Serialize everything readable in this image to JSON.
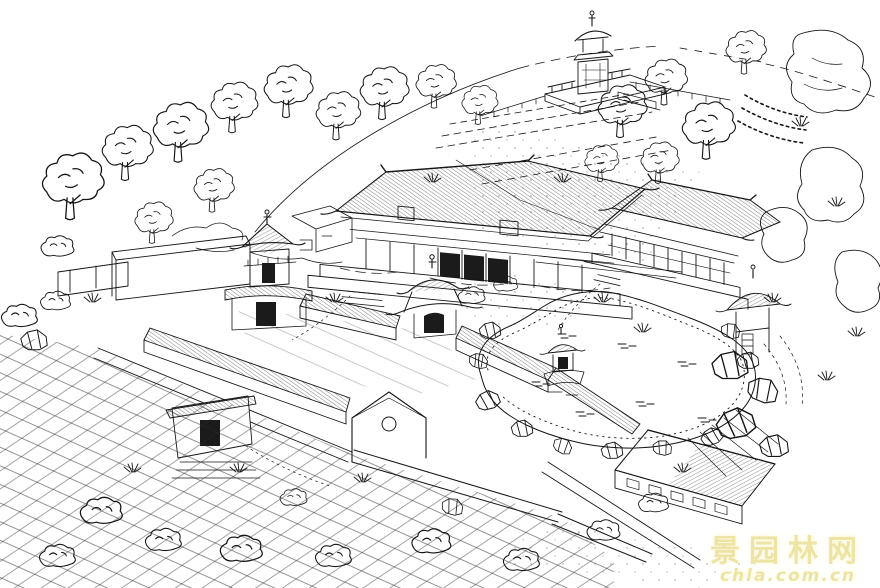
{
  "watermark": {
    "line1": "景园林网",
    "line2": "chla.com.cn",
    "text_color": "#e8dd94",
    "glow_color": "#fdf7d2"
  },
  "palette": {
    "ink": "#161616",
    "paper": "#ffffff"
  }
}
